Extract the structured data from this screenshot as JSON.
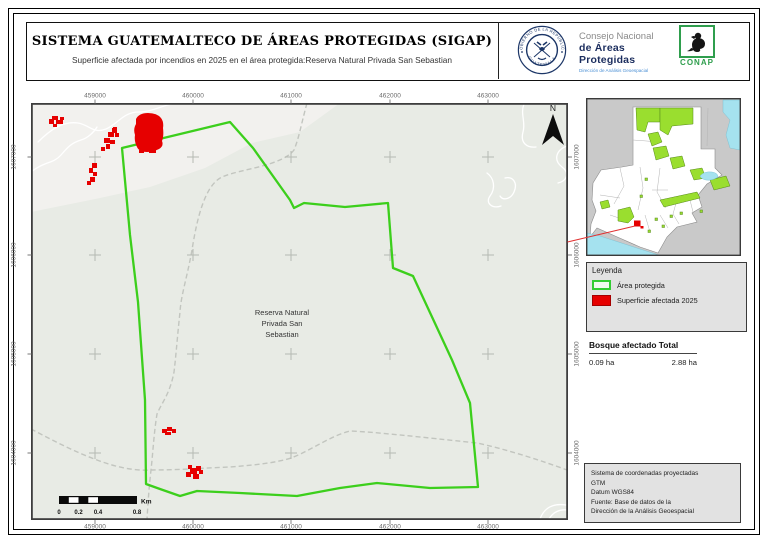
{
  "header": {
    "title": "SISTEMA GUATEMALTECO DE ÁREAS PROTEGIDAS (SIGAP)",
    "subtitle": "Superficie afectada por incendios en 2025 en el área protegida:Reserva Natural Privada San Sebastian",
    "seal_text_top": "GOBIERNO DE LA REPÚBLICA",
    "seal_text_bottom": "GUATEMALA",
    "org_line1": "Consejo Nacional",
    "org_line2": "de Áreas Protegidas",
    "org_line3": "Dirección de Análisis Geoespacial",
    "conap_label": "CONAP"
  },
  "map": {
    "x_ticks": [
      "459000",
      "460000",
      "461000",
      "462000",
      "463000"
    ],
    "y_ticks": [
      "1607000",
      "1606000",
      "1605000",
      "1604000"
    ],
    "area_label": "Reserva Natural Privada San Sebastian",
    "north_label": "N",
    "scalebar": {
      "labels": [
        "0",
        "0.2",
        "0.4",
        "0.8"
      ],
      "unit": "Km"
    }
  },
  "legend": {
    "title": "Leyenda",
    "items": [
      {
        "label": "Área protegida",
        "type": "protected"
      },
      {
        "label": "Superficie afectada 2025",
        "type": "fire"
      }
    ]
  },
  "summary": {
    "title": "Bosque afectado Total",
    "value_left": "0.09 ha",
    "value_right": "2.88 ha"
  },
  "credits": {
    "lines": [
      "Sistema de coordenadas proyectadas",
      "GTM",
      "Datum WGS84",
      "Fuente: Base de datos de la",
      "Dirección de la Análisis Geoespacial"
    ]
  },
  "colors": {
    "protected_green": "#3ccf1c",
    "fire_red": "#e60000",
    "conap_green": "#2f9e4d",
    "navy": "#1b2d5e",
    "inset_green": "#9ade2f",
    "water": "#a5e2ef",
    "map_bg": "#e8ebe5",
    "map_bg_light": "#f2f1ee"
  }
}
